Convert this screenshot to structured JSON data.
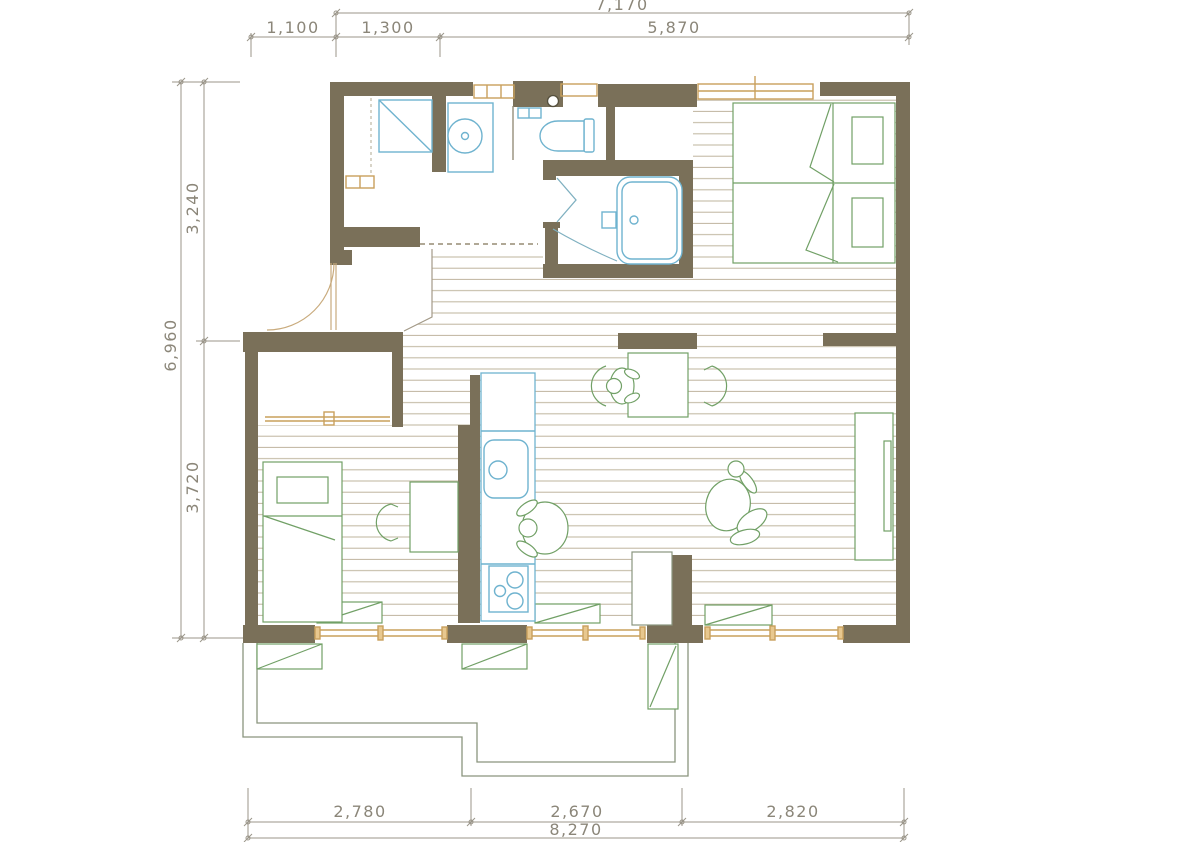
{
  "title": "apartment-floor-plan",
  "dimensions": {
    "top": {
      "total": "7,170",
      "seg1": "1,100",
      "seg2": "1,300",
      "seg3": "5,870"
    },
    "left": {
      "total": "6,960",
      "seg1": "3,240",
      "seg2": "3,720"
    },
    "bottom": {
      "total": "8,270",
      "seg1": "2,780",
      "seg2": "2,670",
      "seg3": "2,820"
    }
  },
  "colors": {
    "wall": "#7a7059",
    "fixture_blue": "#6fb3cf",
    "furniture_green": "#71a066",
    "window_tan": "#c9a05c",
    "floor_line": "#b3a78c",
    "terrace_line": "#8a957e",
    "dimension_text": "#8b8679"
  }
}
